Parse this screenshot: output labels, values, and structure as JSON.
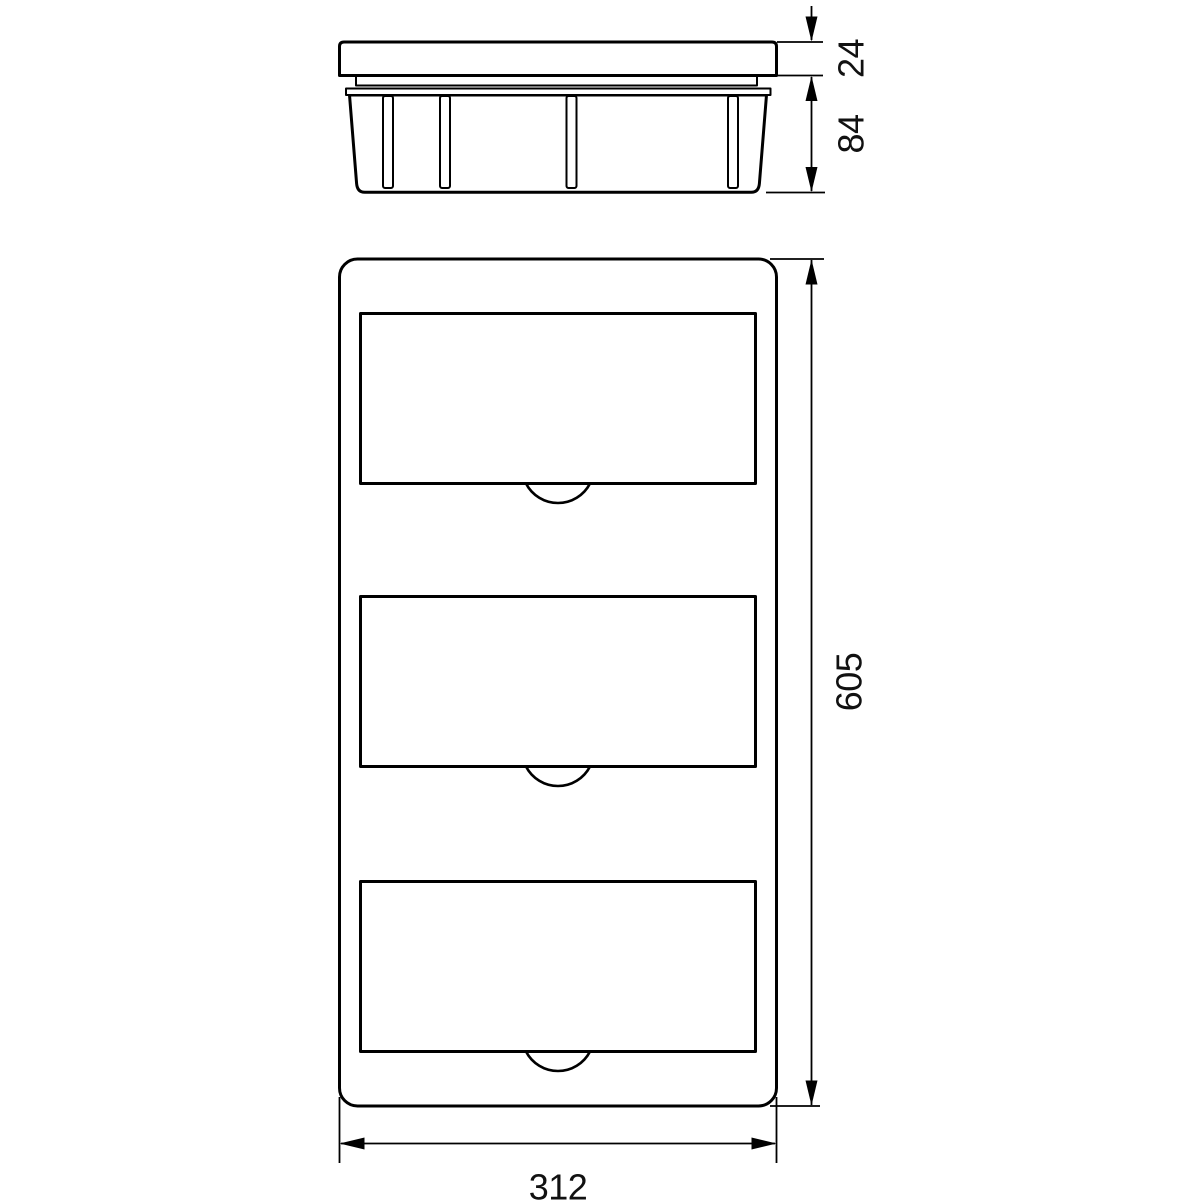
{
  "drawing": {
    "type": "technical-dimension-drawing",
    "subject": "flush-mount distribution box, side profile view and front view",
    "colors": {
      "line": "#000000",
      "text": "#111111",
      "background": "#ffffff"
    },
    "dimensions": {
      "lid_thickness": {
        "value": "24",
        "orientation": "vertical"
      },
      "box_depth": {
        "value": "84",
        "orientation": "vertical"
      },
      "front_height": {
        "value": "605",
        "orientation": "vertical"
      },
      "front_width": {
        "value": "312",
        "orientation": "horizontal"
      }
    }
  }
}
